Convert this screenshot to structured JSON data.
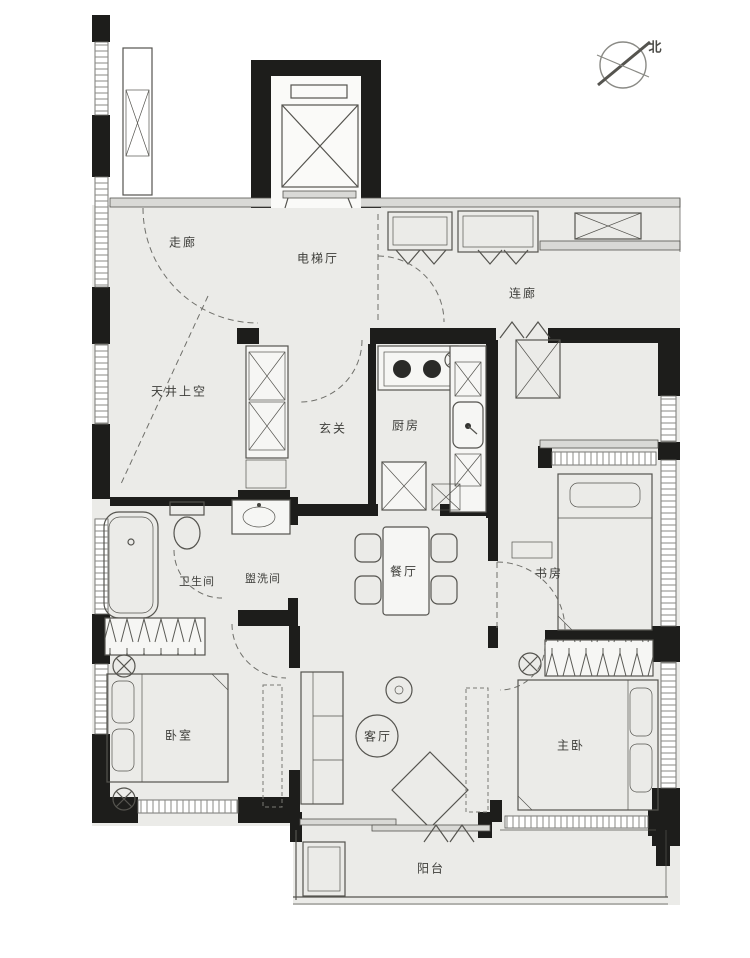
{
  "compass": {
    "north": "北"
  },
  "rooms": {
    "corridor": "走廊",
    "elevator_hall": "电梯厅",
    "link_corridor": "连廊",
    "lightwell": "天井上空",
    "foyer": "玄关",
    "kitchen": "厨房",
    "bathroom": "卫生间",
    "washroom": "盥洗间",
    "dining": "餐厅",
    "study": "书房",
    "bedroom": "卧室",
    "living": "客厅",
    "master_bedroom": "主卧",
    "balcony": "阳台"
  },
  "colors": {
    "wall": "#1d1d1b",
    "line": "#55544f",
    "floor": "#ebebe8",
    "hatch": "#8a8a85"
  }
}
